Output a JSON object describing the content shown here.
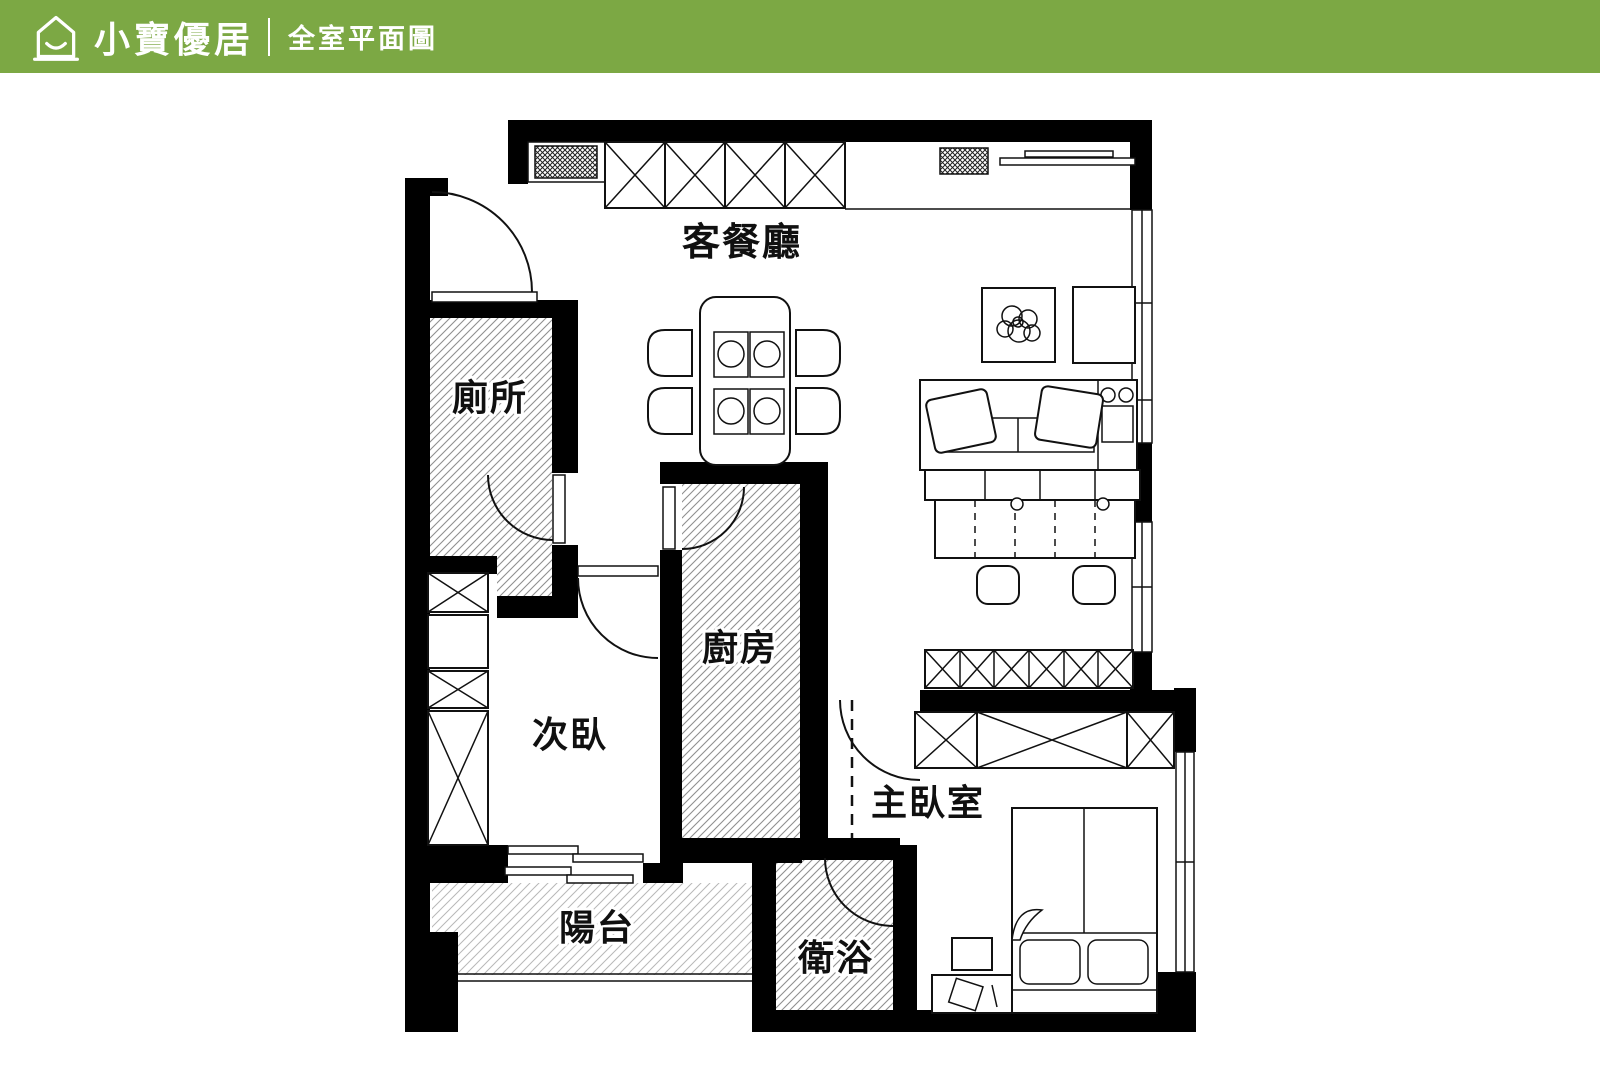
{
  "header": {
    "brand": "小寶優居",
    "subtitle": "全室平面圖",
    "bg_color": "#7CA844",
    "text_color": "#FFFFFF",
    "logo_icon": "house-smile-logo-icon"
  },
  "floor_plan": {
    "type": "residential-floor-plan",
    "rooms": [
      {
        "id": "living_dining",
        "label": "客餐廳"
      },
      {
        "id": "toilet",
        "label": "廁所"
      },
      {
        "id": "kitchen",
        "label": "廚房"
      },
      {
        "id": "second_bedroom",
        "label": "次臥"
      },
      {
        "id": "master_bedroom",
        "label": "主臥室"
      },
      {
        "id": "balcony",
        "label": "陽台"
      },
      {
        "id": "bathroom",
        "label": "衛浴"
      }
    ],
    "colors": {
      "wall": "#000000",
      "line": "#111111",
      "hatch": "#8f8f8f",
      "hatch_light": "#b8b8b8",
      "floor": "#ffffff"
    }
  }
}
